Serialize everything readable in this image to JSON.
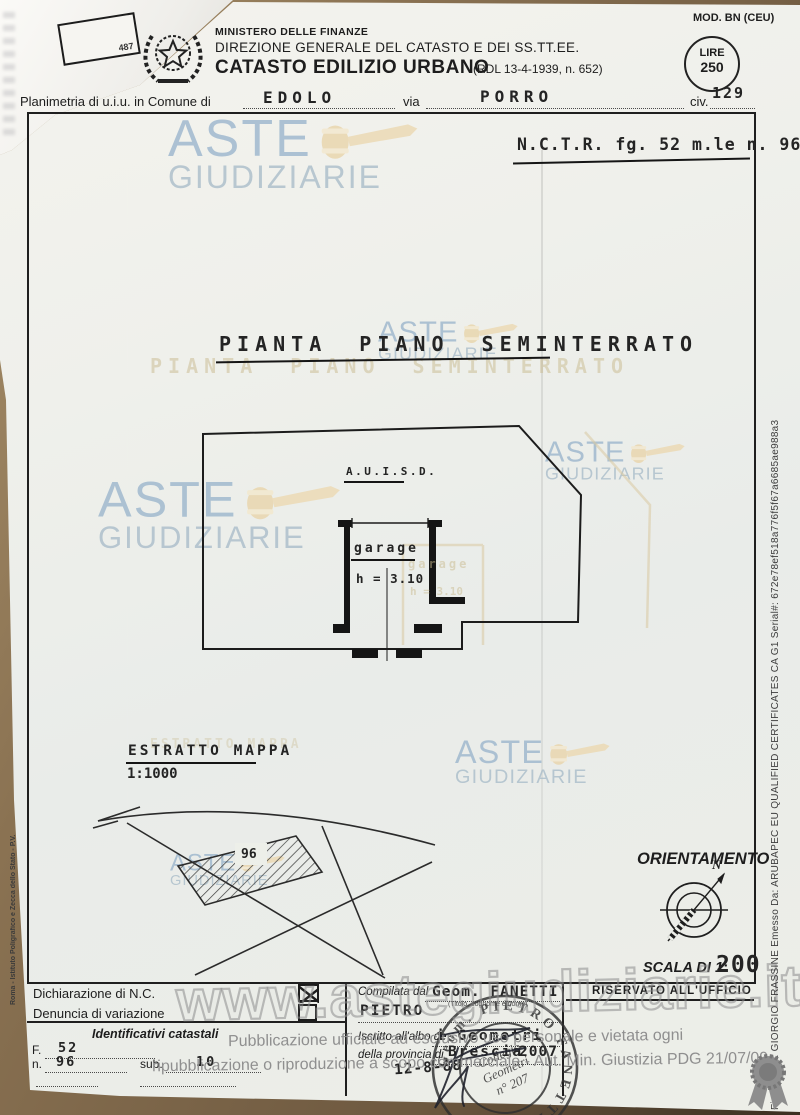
{
  "header": {
    "ministry": "MINISTERO DELLE FINANZE",
    "direction": "DIREZIONE GENERALE DEL CATASTO E DEI SS.TT.EE.",
    "title": "CATASTO EDILIZIO URBANO",
    "title_ref": "(RDL 13-4-1939, n. 652)",
    "mod": "MOD. BN (CEU)",
    "lire_word": "LIRE",
    "lire_amount": "250",
    "corner_stamp": "487"
  },
  "location": {
    "label": "Planimetria di u.i.u. in Comune di",
    "comune": "EDOLO",
    "via_label": "via",
    "via": "PORRO",
    "civ_label": "civ.",
    "civ": "129"
  },
  "nctr": {
    "text": "N.C.T.R. fg. 52 m.le n. 96"
  },
  "plan": {
    "title": "PIANTA PIANO SEMINTERRATO",
    "area_label": "A.U.I.S.D.",
    "room_label": "garage",
    "room_height": "h = 3.10"
  },
  "map": {
    "title": "ESTRATTO MAPPA",
    "scale": "1:1000",
    "parcel": "96"
  },
  "orientation": {
    "title": "ORIENTAMENTO",
    "north": "N",
    "scale_label": "SCALA DI 1:",
    "scale_value": "200"
  },
  "form": {
    "declaration": "Dichiarazione di N.C.",
    "variation": "Denuncia di variazione",
    "cadastral_ids_title": "Identificativi catastali",
    "f_label": "F.",
    "f_value": "52",
    "n_label": "n.",
    "n_value": "96",
    "sub_label": "sub.",
    "sub_value": "10",
    "compiled_label": "Compilata dal",
    "compiled_name1": "Geom.  FANETTI",
    "compiled_name2": "PIETRO",
    "compiled_hint": "(Titolo, cognome e nome)",
    "register_label": "Iscritto all'albo de",
    "register_value": "i  Geometri",
    "province_label": "della provincia di",
    "province_value": "Brescia",
    "province_year": "2007",
    "date_value": "12-8-88",
    "office_label": "RISERVATO ALL'UFFICIO"
  },
  "stamp": {
    "outer_text": "Geom. PIETRO FANETTI",
    "inner_line1": "Collegio",
    "inner_line2": "Geometri",
    "inner_line3": "n° 207"
  },
  "watermarks": {
    "aste": "ASTE",
    "giudiziarie": "GIUDIZIARIE",
    "site": "www.astegiudiziarie.it",
    "disclaimer_line1": "Pubblicazione ufficiale ad esclusivo uso personale e vietata ogni",
    "disclaimer_line2": "ripubblicazione o riproduzione a scopo commerciale - Aut. Min. Giustizia PDG 21/07/09"
  },
  "edges": {
    "signature": "Firmato Da: GIORGIO FRASSINE Emesso Da: ARUBAPEC EU QUALIFIED CERTIFICATES CA G1 Serial#: 672e78ef518a776f5f67a6685ae988a3",
    "printer": "Roma - Istituto Poligrafico e Zecca dello Stato - P.V."
  }
}
